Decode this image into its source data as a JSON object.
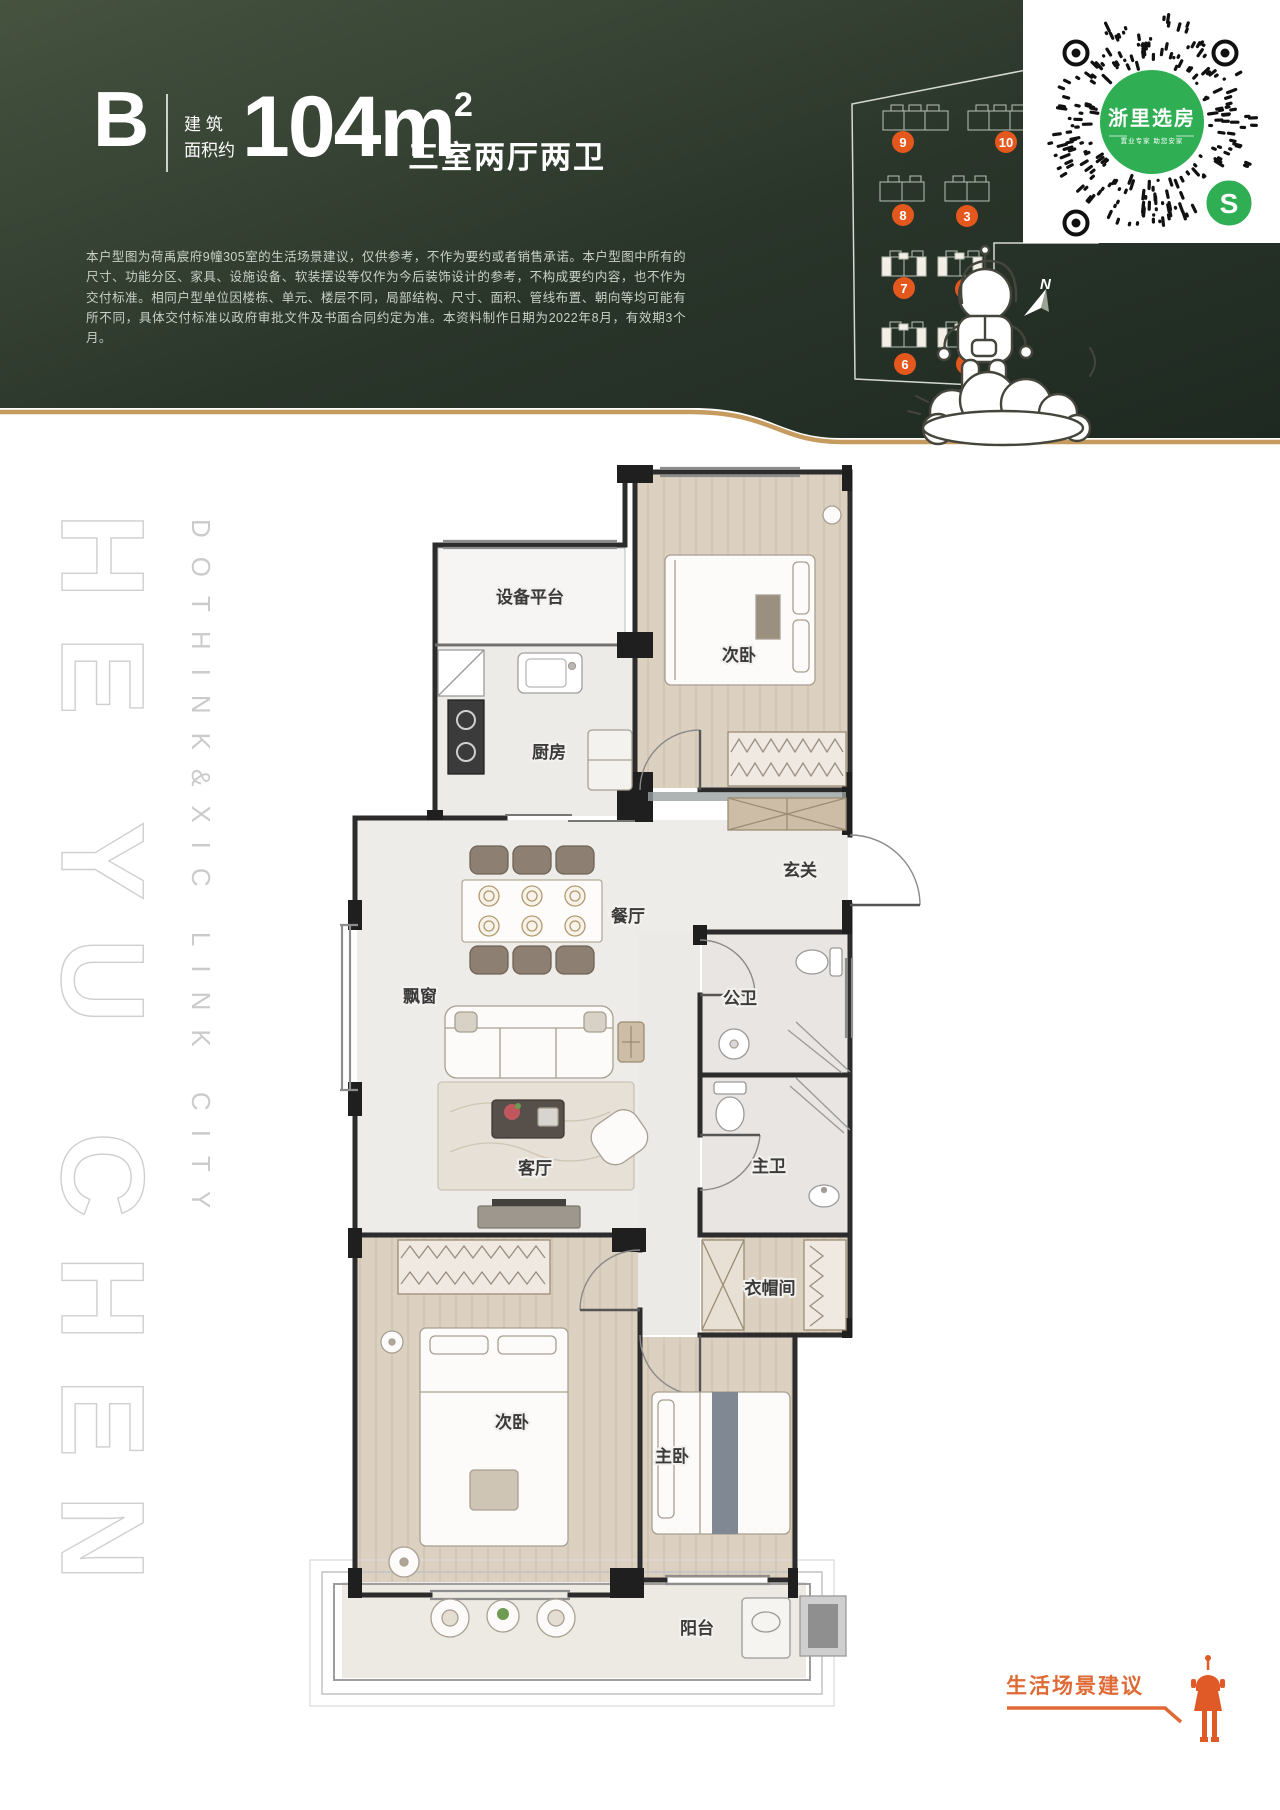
{
  "header": {
    "unit_label": "B",
    "area_prefix_line1": "建 筑",
    "area_prefix_line2": "面积约",
    "area_value": "104m",
    "area_exponent": "2",
    "layout_text": "三室两厅两卫",
    "disclaimer": "本户型图为荷禹宸府9幢305室的生活场景建议，仅供参考，不作为要约或者销售承诺。本户型图中所有的尺寸、功能分区、家具、设施设备、软装摆设等仅作为今后装饰设计的参考，不构成要约内容，也不作为交付标准。相同户型单位因楼栋、单元、楼层不同，局部结构、尺寸、面积、管线布置、朝向等均可能有所不同，具体交付标准以政府审批文件及书面合同约定为准。本资料制作日期为2022年8月，有效期3个月。"
  },
  "site_plan": {
    "north_label": "N",
    "building_numbers": [
      "9",
      "10",
      "8",
      "3",
      "7",
      "4",
      "6",
      "5"
    ]
  },
  "qr": {
    "title": "浙里选房",
    "tagline": "置业专家 助您安家"
  },
  "watermark": {
    "line1": "DOTHINK&XIC LINK CITY",
    "line2": "HE YU CHEN"
  },
  "floor_plan": {
    "rooms": [
      {
        "label": "设备平台"
      },
      {
        "label": "厨房"
      },
      {
        "label": "次卧"
      },
      {
        "label": "玄关"
      },
      {
        "label": "餐厅"
      },
      {
        "label": "飘窗"
      },
      {
        "label": "公卫"
      },
      {
        "label": "客厅"
      },
      {
        "label": "主卫"
      },
      {
        "label": "衣帽间"
      },
      {
        "label": "次卧"
      },
      {
        "label": "主卧"
      },
      {
        "label": "阳台"
      }
    ]
  },
  "footer": {
    "suggestion_label": "生活场景建议"
  },
  "colors": {
    "header_green_dark": "#1f2a22",
    "header_green_light": "#45523f",
    "gold_line": "#c59b60",
    "building_orange": "#e4581d",
    "qr_green": "#2fae54",
    "footer_orange": "#df6a35"
  }
}
